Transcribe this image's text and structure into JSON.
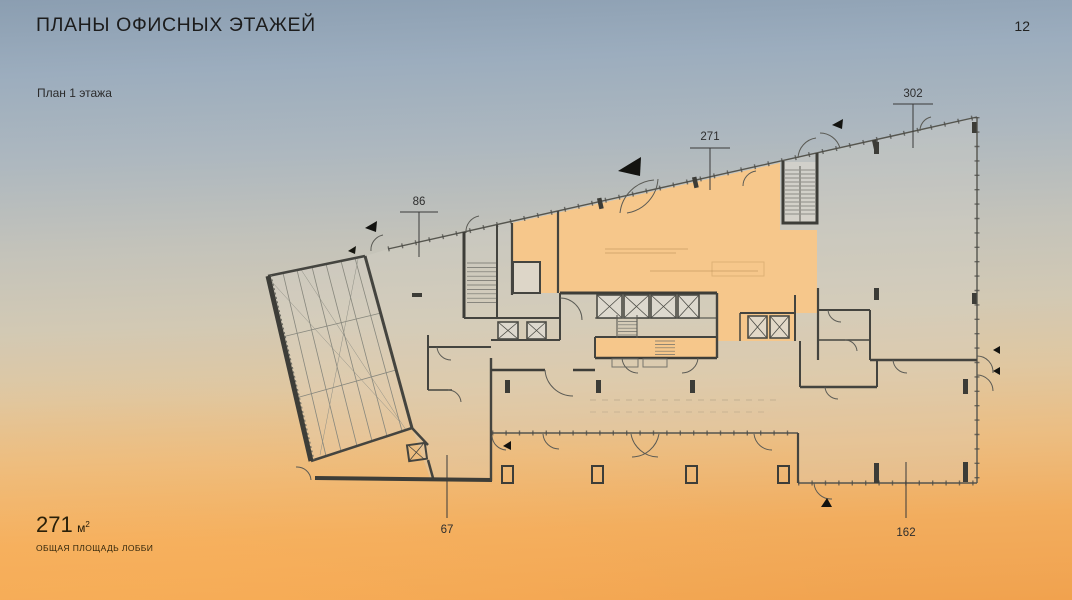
{
  "slide": {
    "title": "ПЛАНЫ ОФИСНЫХ ЭТАЖЕЙ",
    "page_number": "12",
    "subtitle": "План 1 этажа",
    "footer": {
      "area_value": "271",
      "area_unit_base": "м",
      "area_unit_sup": "2",
      "area_caption": "ОБЩАЯ ПЛОЩАДЬ ЛОББИ"
    }
  },
  "floor_plan": {
    "type": "architectural-floor-plan",
    "highlighted_zone": "лобби (271 м²)",
    "dimension_labels": {
      "top_left": "86",
      "top_center": "271",
      "top_right": "302",
      "bottom_left": "67",
      "bottom_right": "162"
    },
    "colors": {
      "highlight": "#f6c78b",
      "walls": "#4b4b47",
      "background_top": "#8b9eb1",
      "background_bottom": "#f1a24e"
    }
  }
}
